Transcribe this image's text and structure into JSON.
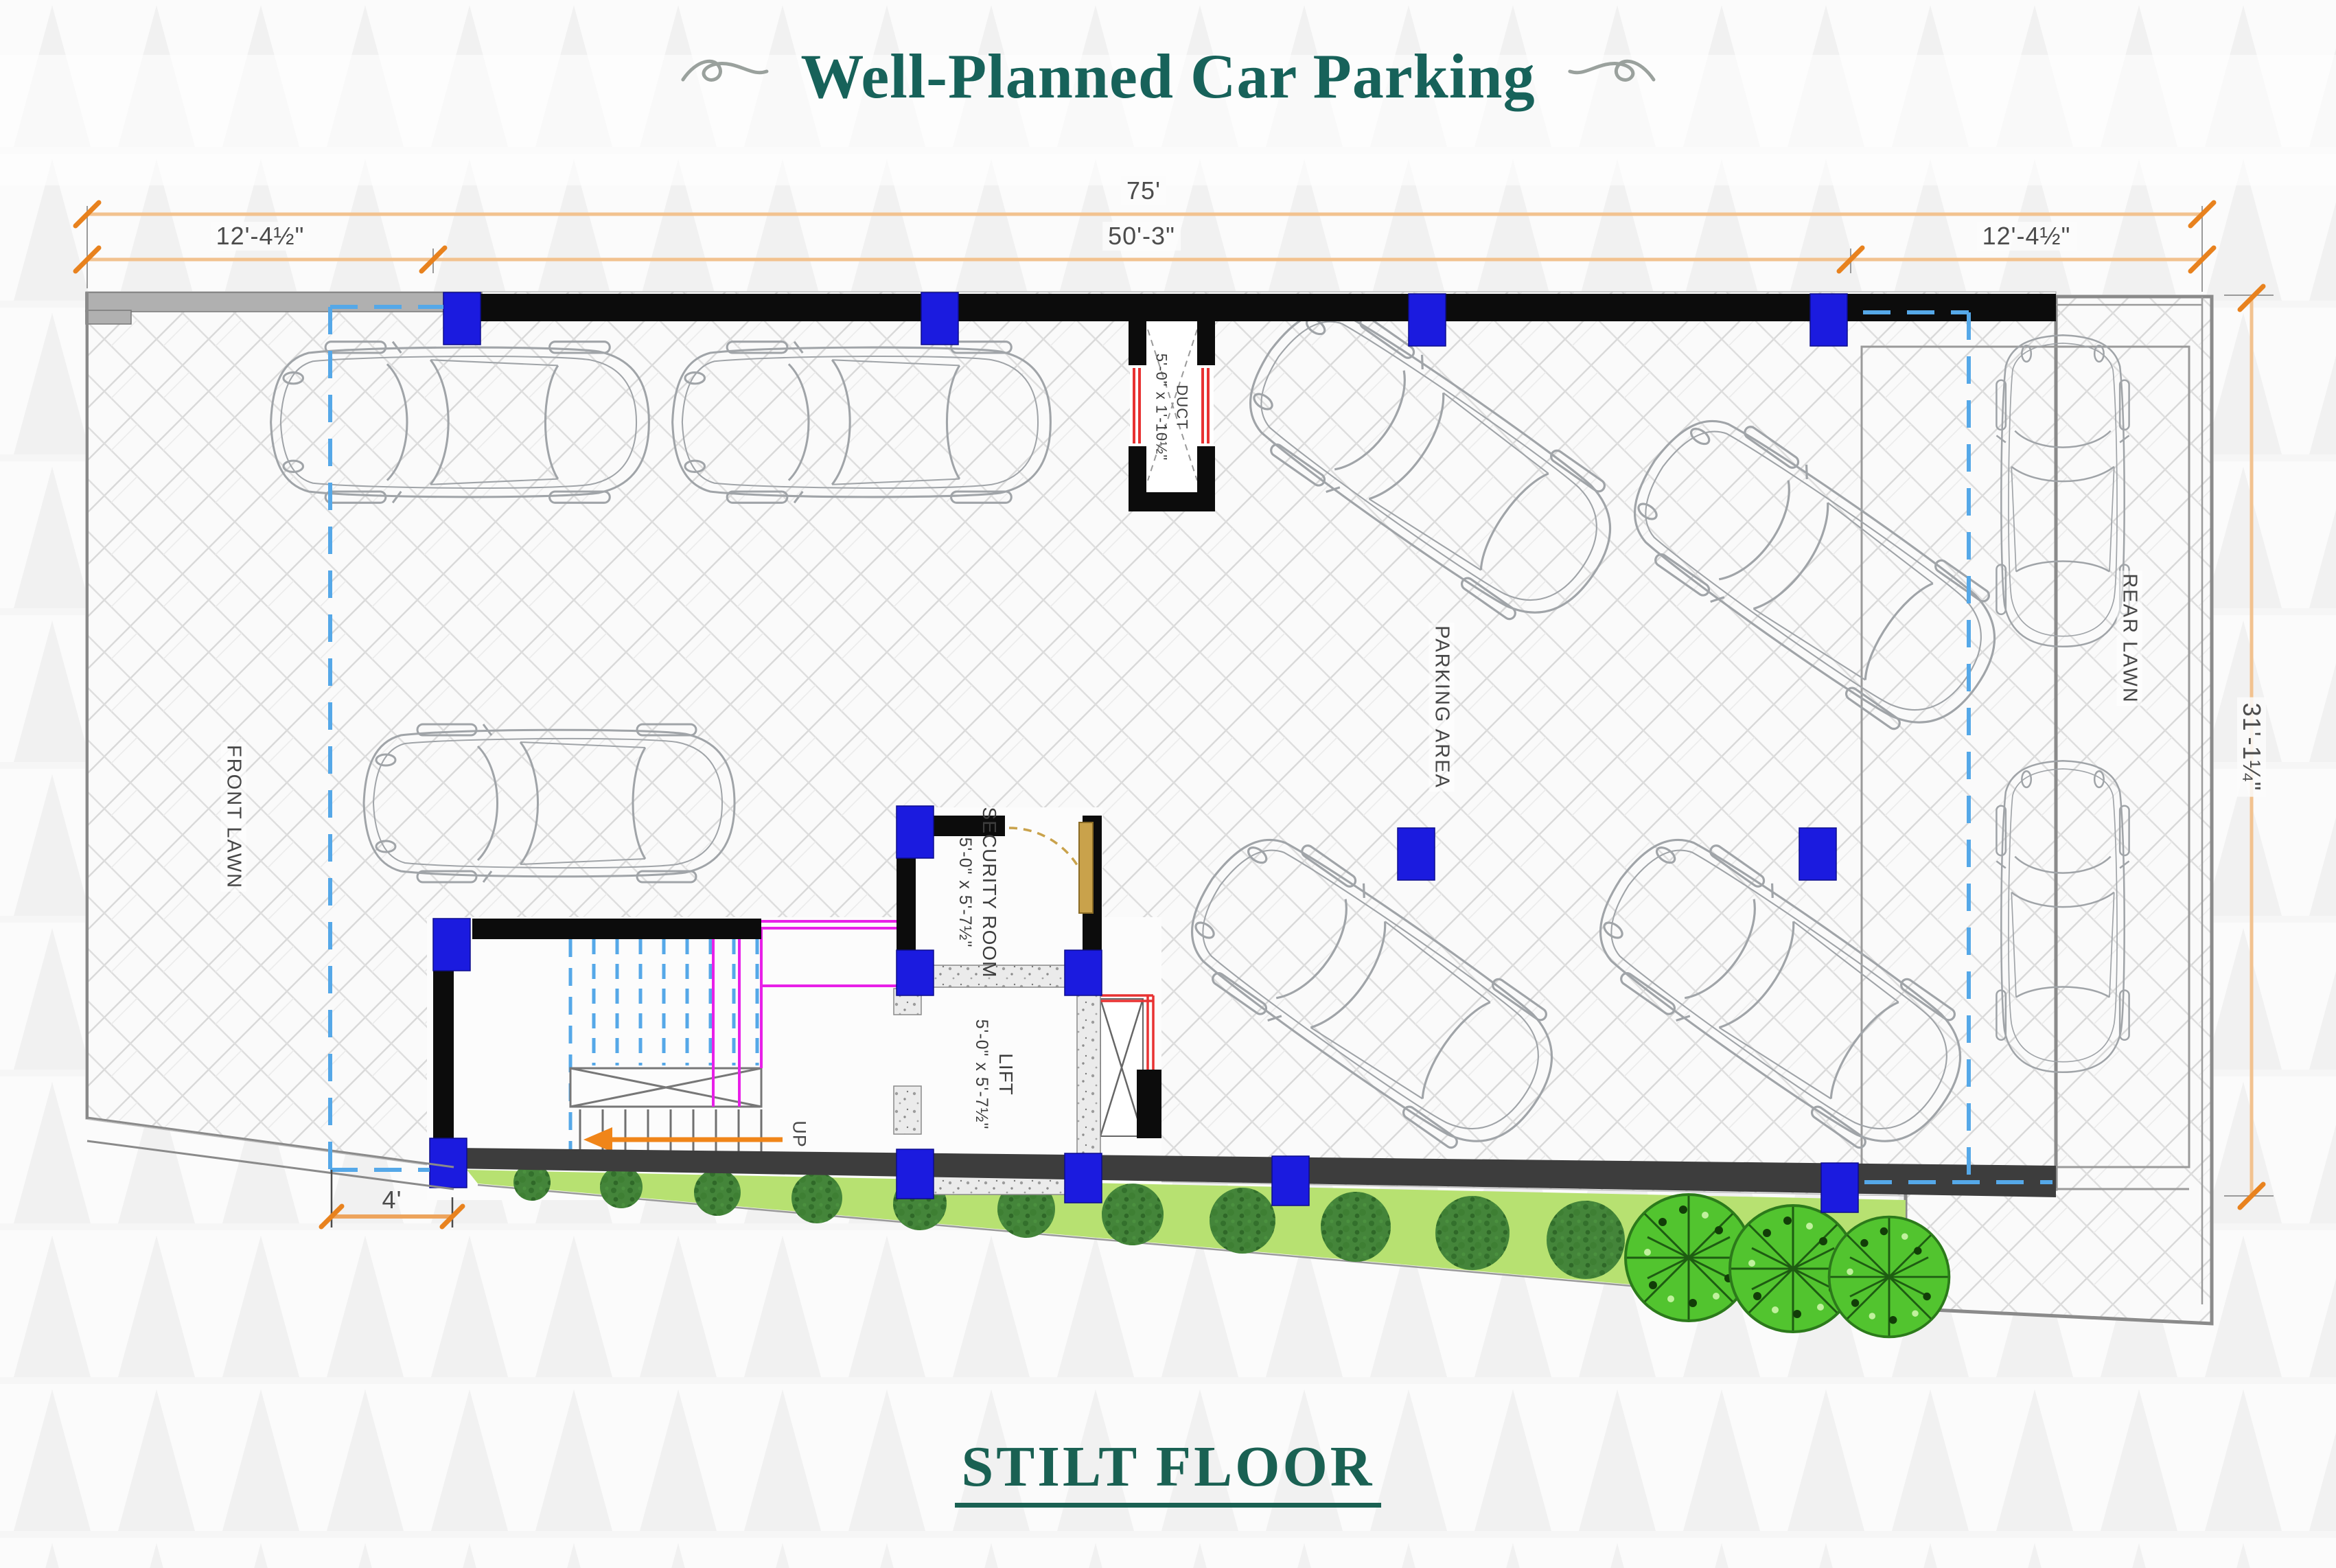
{
  "title": "Well-Planned Car Parking",
  "floor_title": "STILT FLOOR",
  "dimensions": {
    "overall_width": "75'",
    "front_setback": "12'-4½\"",
    "building_width": "50'-3\"",
    "rear_setback": "12'-4½\"",
    "overall_depth": "31'-1¼\"",
    "ramp_width": "4'"
  },
  "rooms": {
    "security": {
      "name": "SECURITY ROOM",
      "size": "5'-0\" x 5'-7½\""
    },
    "lift": {
      "name": "LIFT",
      "size": "5'-0\" x 5'-7½\""
    },
    "duct": {
      "name": "DUCT",
      "size": "5'-0\" x 1'-10½\""
    }
  },
  "labels": {
    "front_lawn": "FRONT LAWN",
    "rear_lawn": "REAR LAWN",
    "parking_area": "PARKING AREA",
    "stair_direction": "UP"
  },
  "colors": {
    "heading_green": "#17625a",
    "column_blue": "#1b1bdf",
    "dimension_orange": "#e8821e",
    "lawn_green": "#b7e171",
    "plot_line_blue": "#55a8e8",
    "railing_magenta": "#e820e8",
    "door_wood": "#c9a24b",
    "duct_red": "#e83232"
  }
}
